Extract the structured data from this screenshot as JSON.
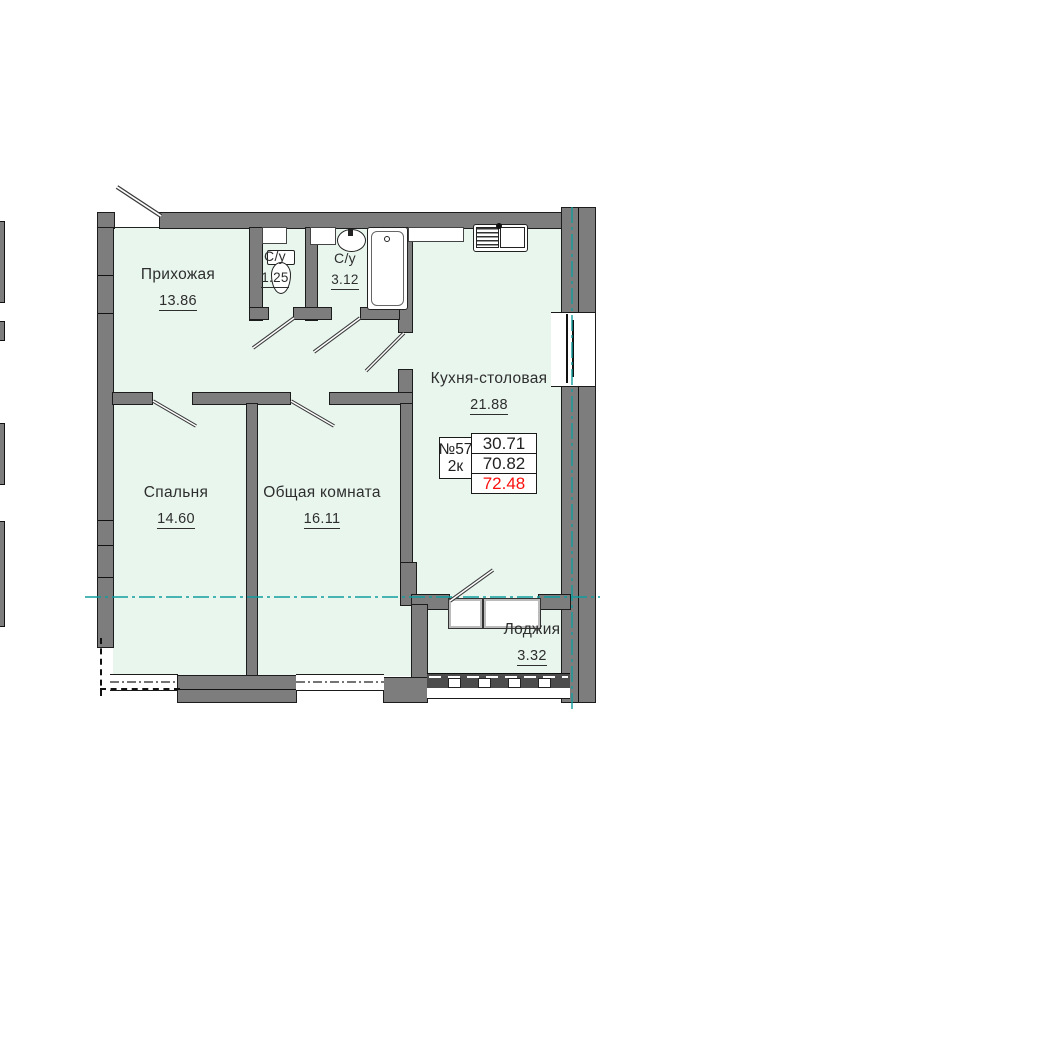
{
  "plan": {
    "title": "apartment-floor-plan",
    "rooms": [
      {
        "id": "hallway",
        "name": "Прихожая",
        "area": "13.86"
      },
      {
        "id": "wc-small",
        "name": "С/у",
        "area": "1.25"
      },
      {
        "id": "wc-big",
        "name": "С/у",
        "area": "3.12"
      },
      {
        "id": "kitchen",
        "name": "Кухня-столовая",
        "area": "21.88"
      },
      {
        "id": "bedroom",
        "name": "Спальня",
        "area": "14.60"
      },
      {
        "id": "living",
        "name": "Общая комната",
        "area": "16.11"
      },
      {
        "id": "loggia",
        "name": "Лоджия",
        "area": "3.32"
      }
    ],
    "unit_info": {
      "number": "№57",
      "type": "2к",
      "living_area": "30.71",
      "area_main": "70.82",
      "area_total": "72.48"
    },
    "colors": {
      "room_fill": "#e8f6ee",
      "wall_gray": "#7d7d7d",
      "axis_teal": "#0f9d9e",
      "total_red": "#fb100d",
      "text": "#2e2e2e"
    }
  }
}
